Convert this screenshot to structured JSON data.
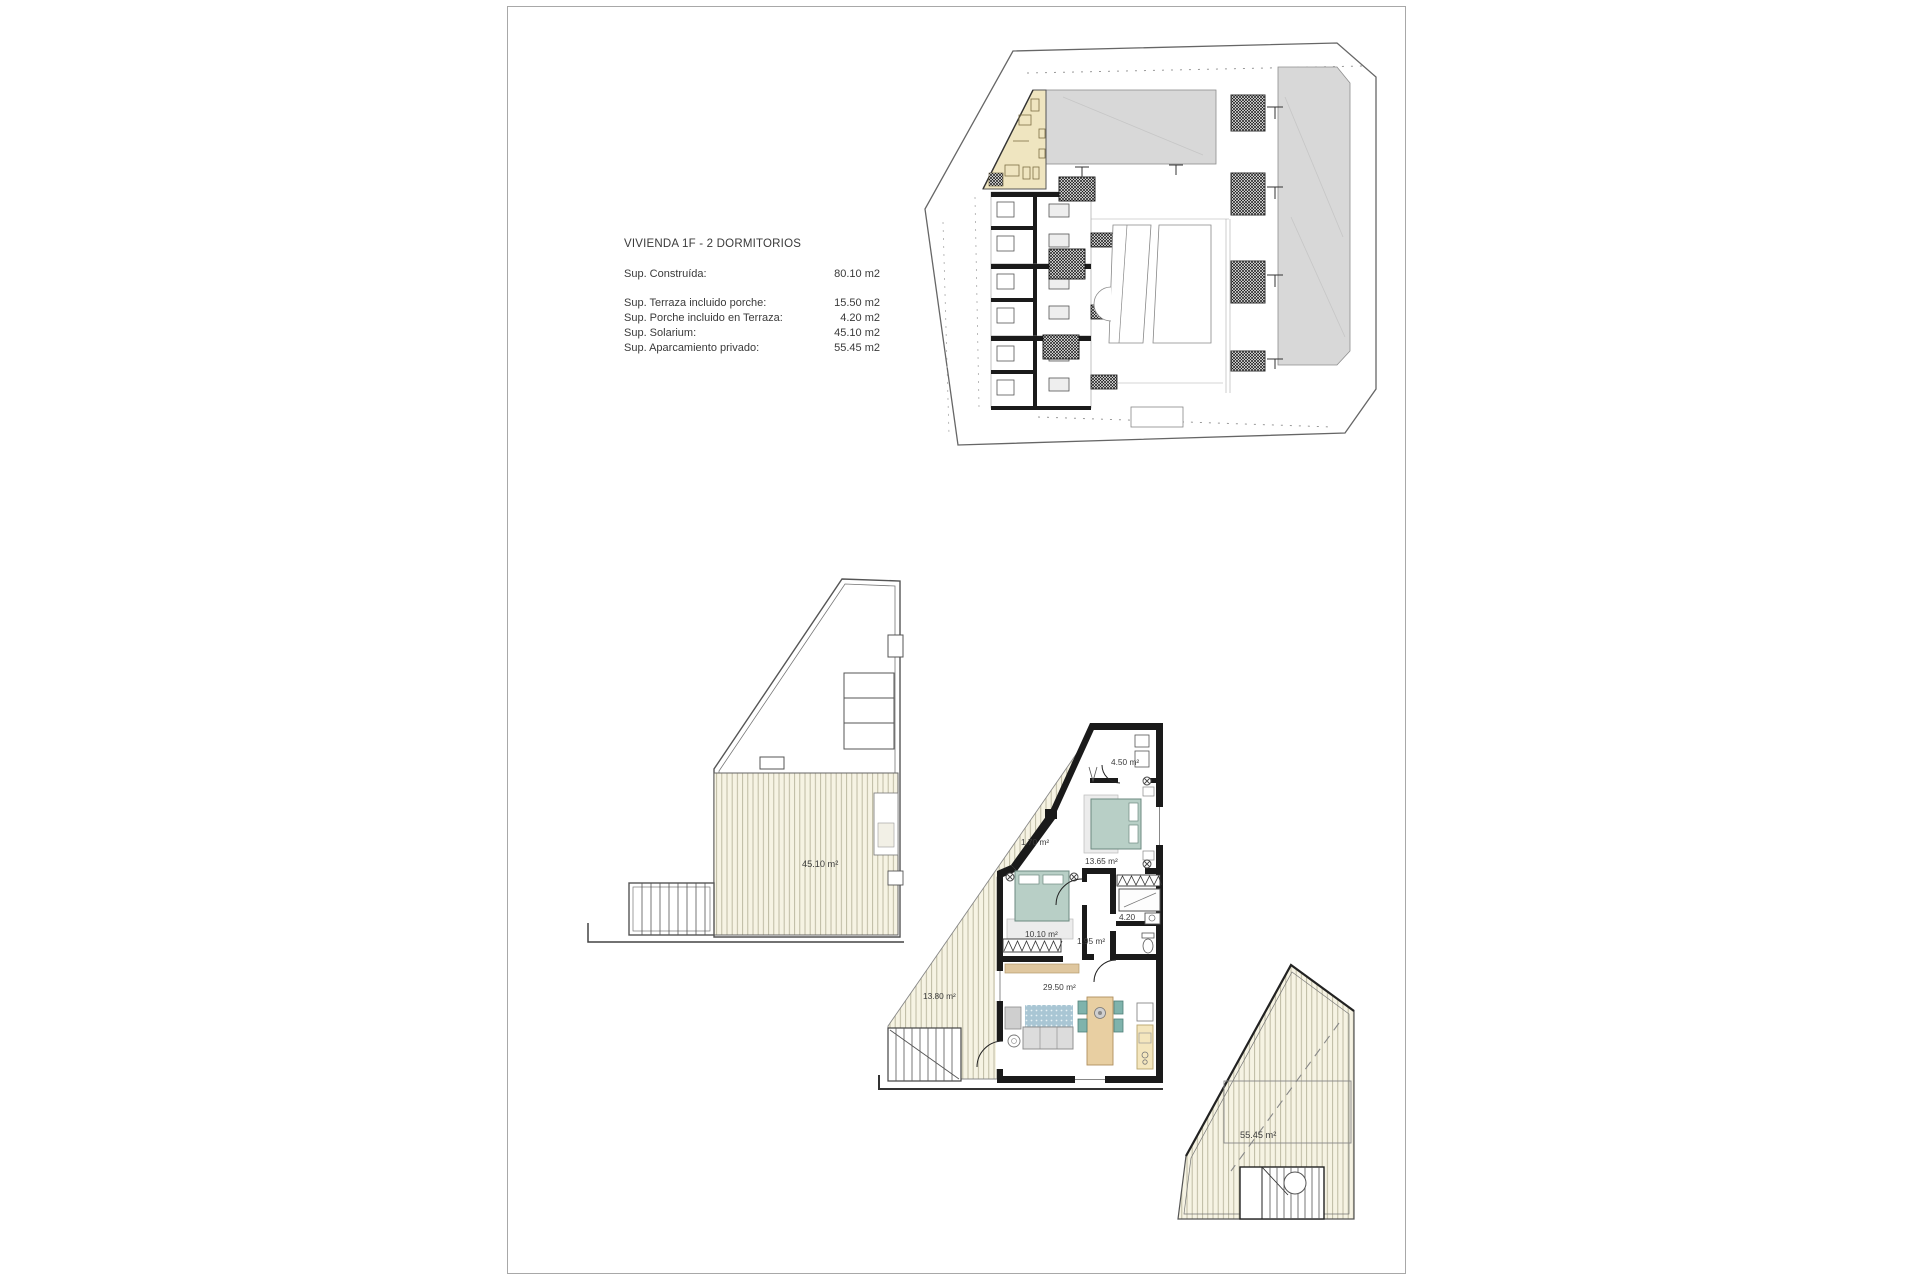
{
  "page": {
    "info": {
      "title": "VIVIENDA  1F - 2 DORMITORIOS",
      "rows": [
        {
          "label": "Sup. Construída:",
          "value": "80.10 m2"
        },
        {
          "label": "Sup. Terraza incluido porche:",
          "value": "15.50 m2"
        },
        {
          "label": "Sup. Porche incluido en Terraza:",
          "value": "4.20 m2"
        },
        {
          "label": "Sup. Solarium:",
          "value": "45.10 m2"
        },
        {
          "label": "Sup. Aparcamiento privado:",
          "value": "55.45 m2"
        }
      ]
    },
    "plans": {
      "solarium_area": "45.10 m²",
      "parking_area": "55.45 m²",
      "main": {
        "utility": "4.50 m²",
        "bedroom1": "13.65 m²",
        "corridor": "1.70 m²",
        "bedroom2": "10.10 m²",
        "hall": "1.95 m²",
        "bath": "4.20",
        "living": "29.50 m²",
        "terrace": "13.80 m²"
      }
    },
    "colors": {
      "highlight": "#EFE5C0",
      "sitegray": "#D8D8D8",
      "deck": "#F6F3E3",
      "bed": "#B8CFC6",
      "rug": "#A9C6D4",
      "wood": "#E8CFA2",
      "wall": "#1A1A1A",
      "ink": "#3A3A3A"
    }
  }
}
